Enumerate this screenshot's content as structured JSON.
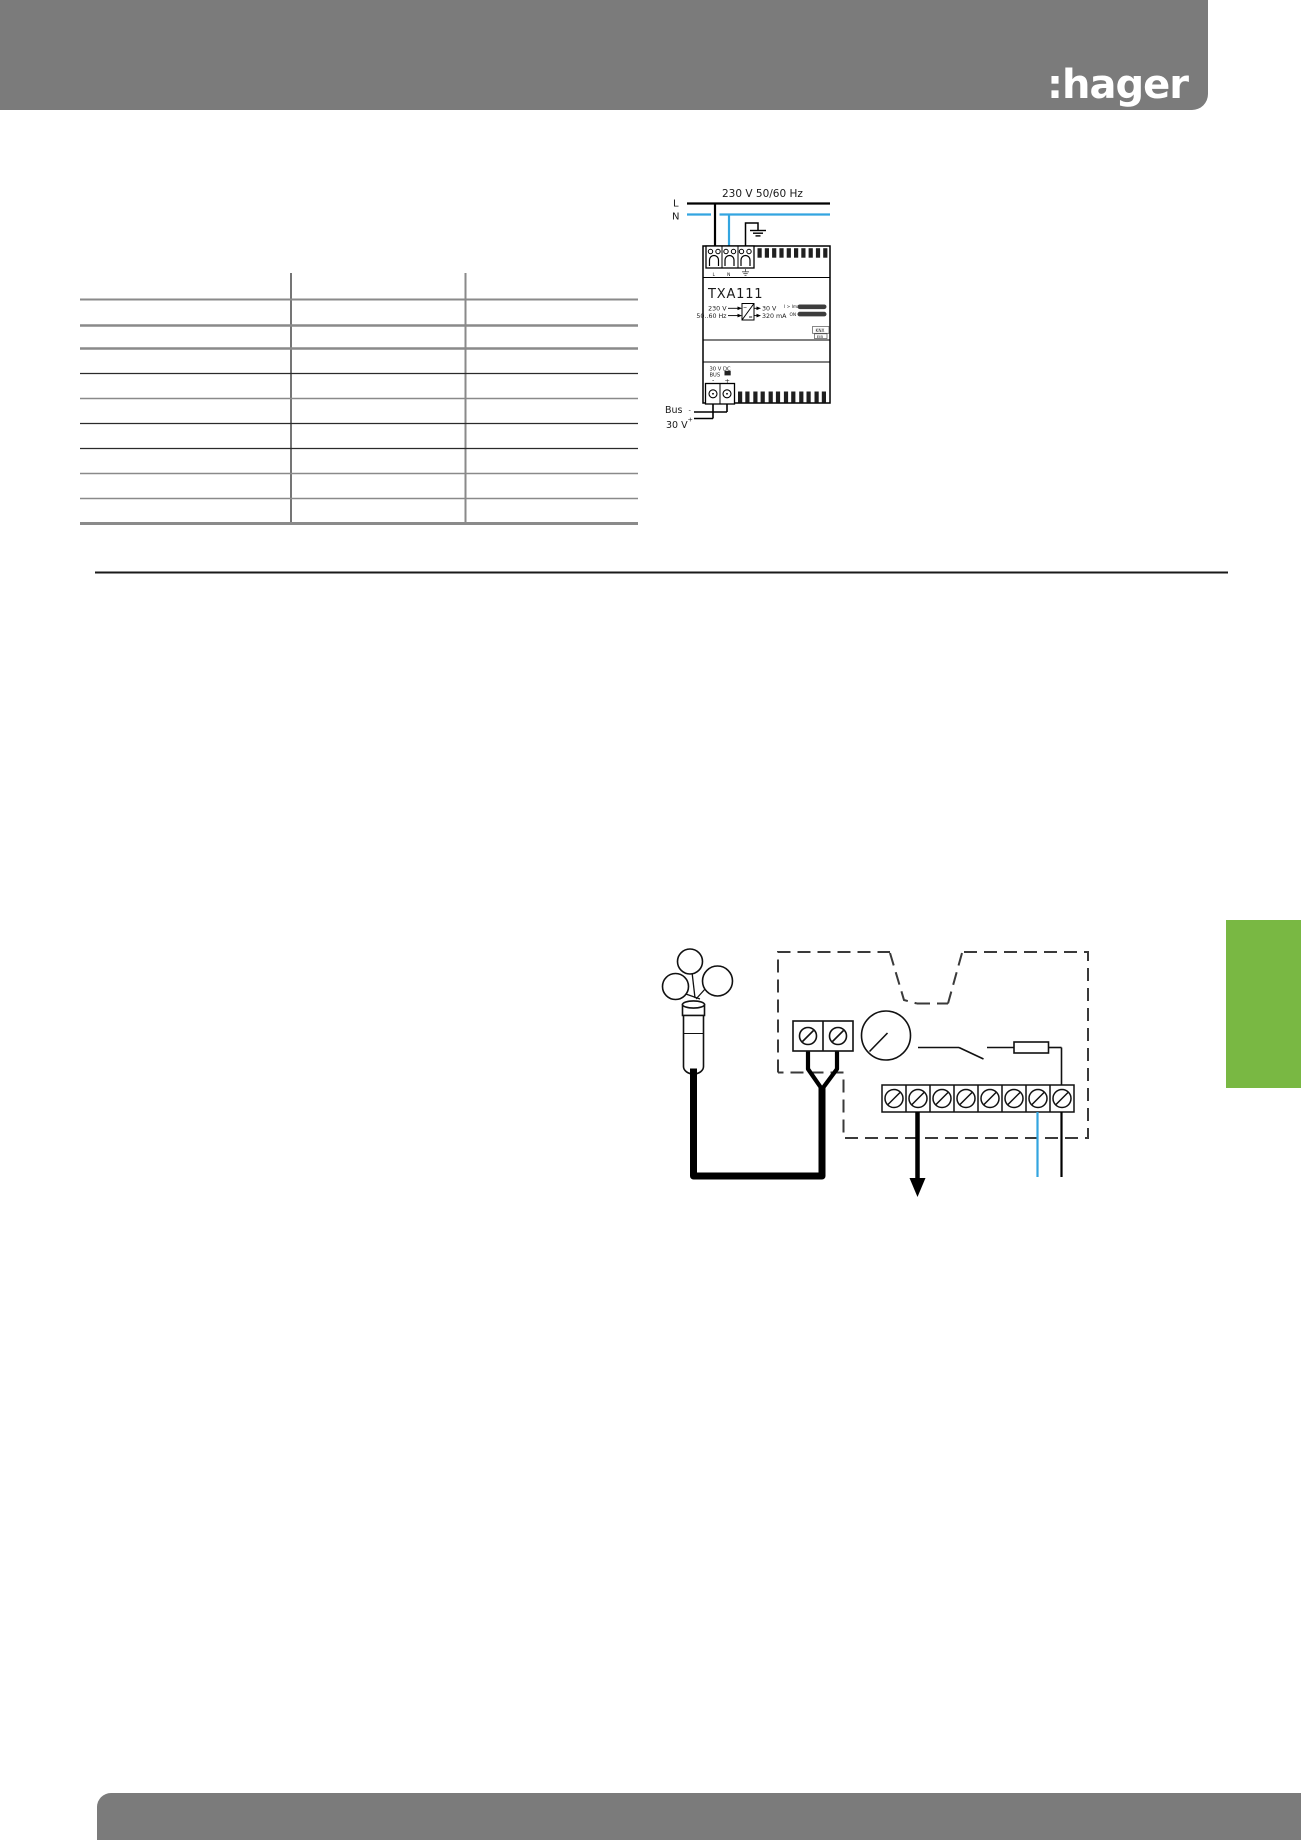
{
  "page": {
    "logo_text": ":hager",
    "colors": {
      "header_gray": "#7b7b7b",
      "accent_green": "#79b843",
      "wire_blue": "#33a5e0",
      "wire_black": "#000000"
    }
  },
  "power_diagram": {
    "supply_label": "230 V 50/60 Hz",
    "phase_label": "L",
    "neutral_label": "N",
    "device": {
      "model": "TXA111",
      "primary_voltage": "230 V",
      "primary_frequency": "50..60 Hz",
      "secondary_voltage": "30 V",
      "secondary_current": "320 mA",
      "converter_ac_symbol": "~",
      "converter_dc_symbol": "=",
      "overcurrent_led_label": "I > Imax",
      "on_led_label": "ON",
      "knx_line1": "KNX",
      "knx_line2": "EIB",
      "terminal_phase": "L",
      "terminal_neutral": "N",
      "bus_output_line1": "30 V DC",
      "bus_output_line2": "BUS",
      "bus_minus": "-",
      "bus_plus": "+"
    },
    "bus_wire_label": "Bus",
    "bus_wire_voltage": "30 V",
    "bus_wire_minus": "-",
    "bus_wire_plus": "+"
  }
}
